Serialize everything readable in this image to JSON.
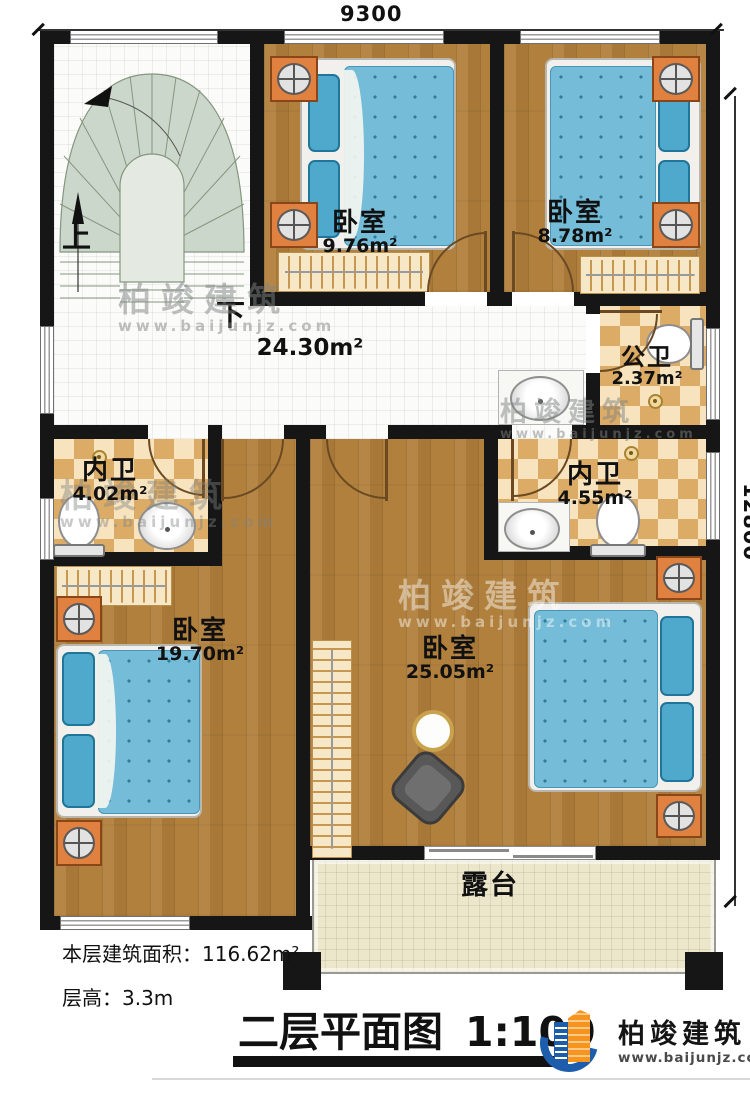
{
  "dimensions": {
    "top": "9300",
    "right": "12800"
  },
  "stairs": {
    "up": "上",
    "down": "下"
  },
  "hall": {
    "area": "24.30m²"
  },
  "rooms": {
    "bedroom_top_left": {
      "name": "卧室",
      "area": "9.76m²"
    },
    "bedroom_top_right": {
      "name": "卧室",
      "area": "8.78m²"
    },
    "public_bath": {
      "name": "公卫",
      "area": "2.37m²"
    },
    "ensuite_left": {
      "name": "内卫",
      "area": "4.02m²"
    },
    "ensuite_right": {
      "name": "内卫",
      "area": "4.55m²"
    },
    "bedroom_bottom_left": {
      "name": "卧室",
      "area": "19.70m²"
    },
    "bedroom_bottom_right": {
      "name": "卧室",
      "area": "25.05m²"
    },
    "terrace": {
      "name": "露台"
    }
  },
  "info": {
    "floor_area_label": "本层建筑面积：",
    "floor_area_value": "116.62m²",
    "height_label": "层高：",
    "height_value": "3.3m"
  },
  "title": {
    "text": "二层平面图",
    "scale": "1:100"
  },
  "brand": {
    "name": "柏竣建筑",
    "url": "www.baijunjz.com"
  },
  "watermark": {
    "name": "柏竣建筑",
    "url": "www.baijunjz.com"
  },
  "colors": {
    "wall": "#161616",
    "wood_floor": "#b1803c",
    "hall_tile": "#fbfbf9",
    "bath_tile_dark": "#dcab66",
    "bath_tile_light": "#f7e3bd",
    "terrace_tile": "#ece6cb",
    "stair": "#ccd7cb",
    "bed": "#74bcd8",
    "nightstand": "#e0813f",
    "brand_blue": "#1d5dab",
    "brand_orange": "#f7941d"
  }
}
